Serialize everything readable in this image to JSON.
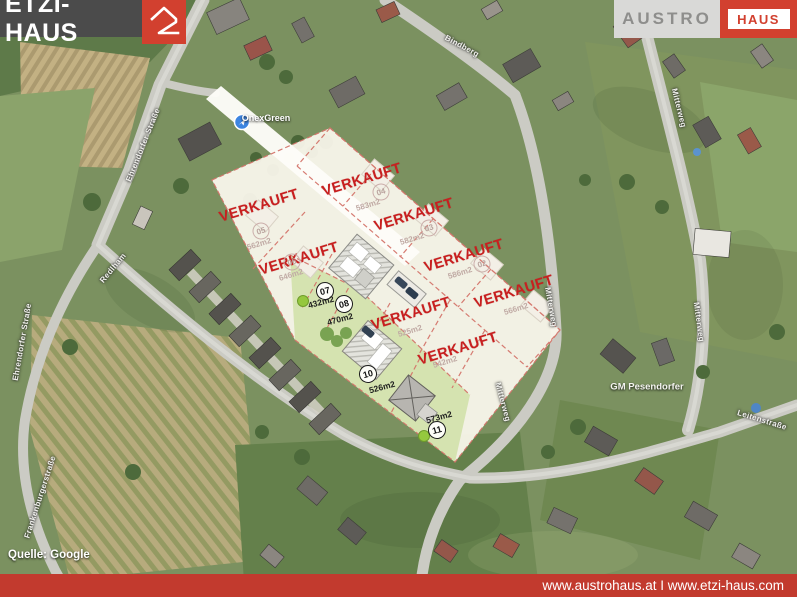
{
  "branding": {
    "etzi_logo": "ETZI-HAUS",
    "austro_logo_left": "AUSTRO",
    "austro_logo_right": "HAUS",
    "brand_red": "#d2402f",
    "logo_bar_gray": "#4b4b4b"
  },
  "footer": {
    "urls": "www.austrohaus.at I www.etzi-haus.com",
    "bar_color": "#c23a2e",
    "source": "Quelle: Google"
  },
  "map": {
    "poi_label": "OnexGreen",
    "place_label": "GM Pesendorfer",
    "street_labels": [
      {
        "name": "Ehrendorfer Straße"
      },
      {
        "name": "Ehrendorfer Straße"
      },
      {
        "name": "Redlham"
      },
      {
        "name": "Bindberg"
      },
      {
        "name": "Mitterweg"
      },
      {
        "name": "Mitterweg"
      },
      {
        "name": "Mitterweg"
      },
      {
        "name": "Mitterweg"
      },
      {
        "name": "Leitenstraße"
      },
      {
        "name": "Frankenburgerstraße"
      }
    ]
  },
  "site_plan": {
    "sold_label": "VERKAUFT",
    "sold_color": "#c81f1f",
    "plan_bg": "#faf6ec",
    "green_area": "#d3e2ad",
    "plots": [
      {
        "number": "05",
        "area": "562m2",
        "sold": true
      },
      {
        "number": "04",
        "area": "583m2",
        "sold": true
      },
      {
        "number": "06",
        "area": "646m2",
        "sold": true
      },
      {
        "number": "03",
        "area": "582m2",
        "sold": true
      },
      {
        "number": "02",
        "area": "586m2",
        "sold": true
      },
      {
        "number": "",
        "area": "566m2",
        "sold": true
      },
      {
        "number": "07",
        "area": "432m2",
        "sold": false
      },
      {
        "number": "08",
        "area": "470m2",
        "sold": false
      },
      {
        "number": "",
        "area": "525m2",
        "sold": true
      },
      {
        "number": "10",
        "area": "526m2",
        "sold": false
      },
      {
        "number": "",
        "area": "542m2",
        "sold": true
      },
      {
        "number": "11",
        "area": "573m2",
        "sold": false
      }
    ]
  }
}
